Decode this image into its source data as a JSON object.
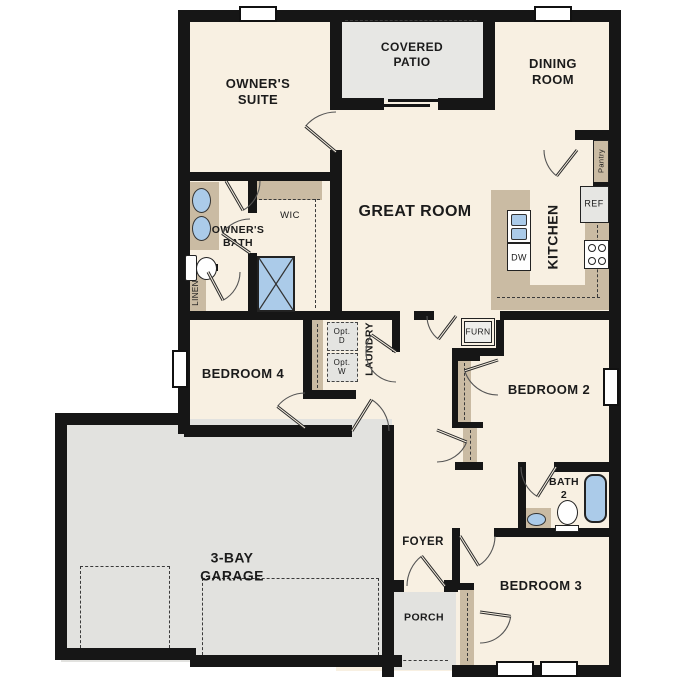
{
  "labels": {
    "owners_suite": "OWNER'S\nSUITE",
    "covered_patio": "COVERED\nPATIO",
    "dining_room": "DINING\nROOM",
    "great_room": "GREAT ROOM",
    "kitchen": "KITCHEN",
    "pantry": "Pantry",
    "ref": "REF",
    "dw": "DW",
    "owners_bath": "OWNER'S\nBATH",
    "wic": "WIC",
    "linen": "LINEN",
    "bedroom4": "BEDROOM 4",
    "laundry": "LAUNDRY",
    "opt_d": "Opt.\nD",
    "opt_w": "Opt.\nW",
    "furn": "FURN",
    "bedroom2": "BEDROOM 2",
    "bath2": "BATH\n2",
    "garage": "3-BAY\nGARAGE",
    "foyer": "FOYER",
    "porch": "PORCH",
    "bedroom3": "BEDROOM 3"
  },
  "colors": {
    "wall": "#161616",
    "interior_floor": "#f8f0e2",
    "hardscape_floor": "#e3e3e0",
    "casework_tan": "#cabba3",
    "fixture_blue": "#abcbe9",
    "text": "#1b1b1b"
  }
}
